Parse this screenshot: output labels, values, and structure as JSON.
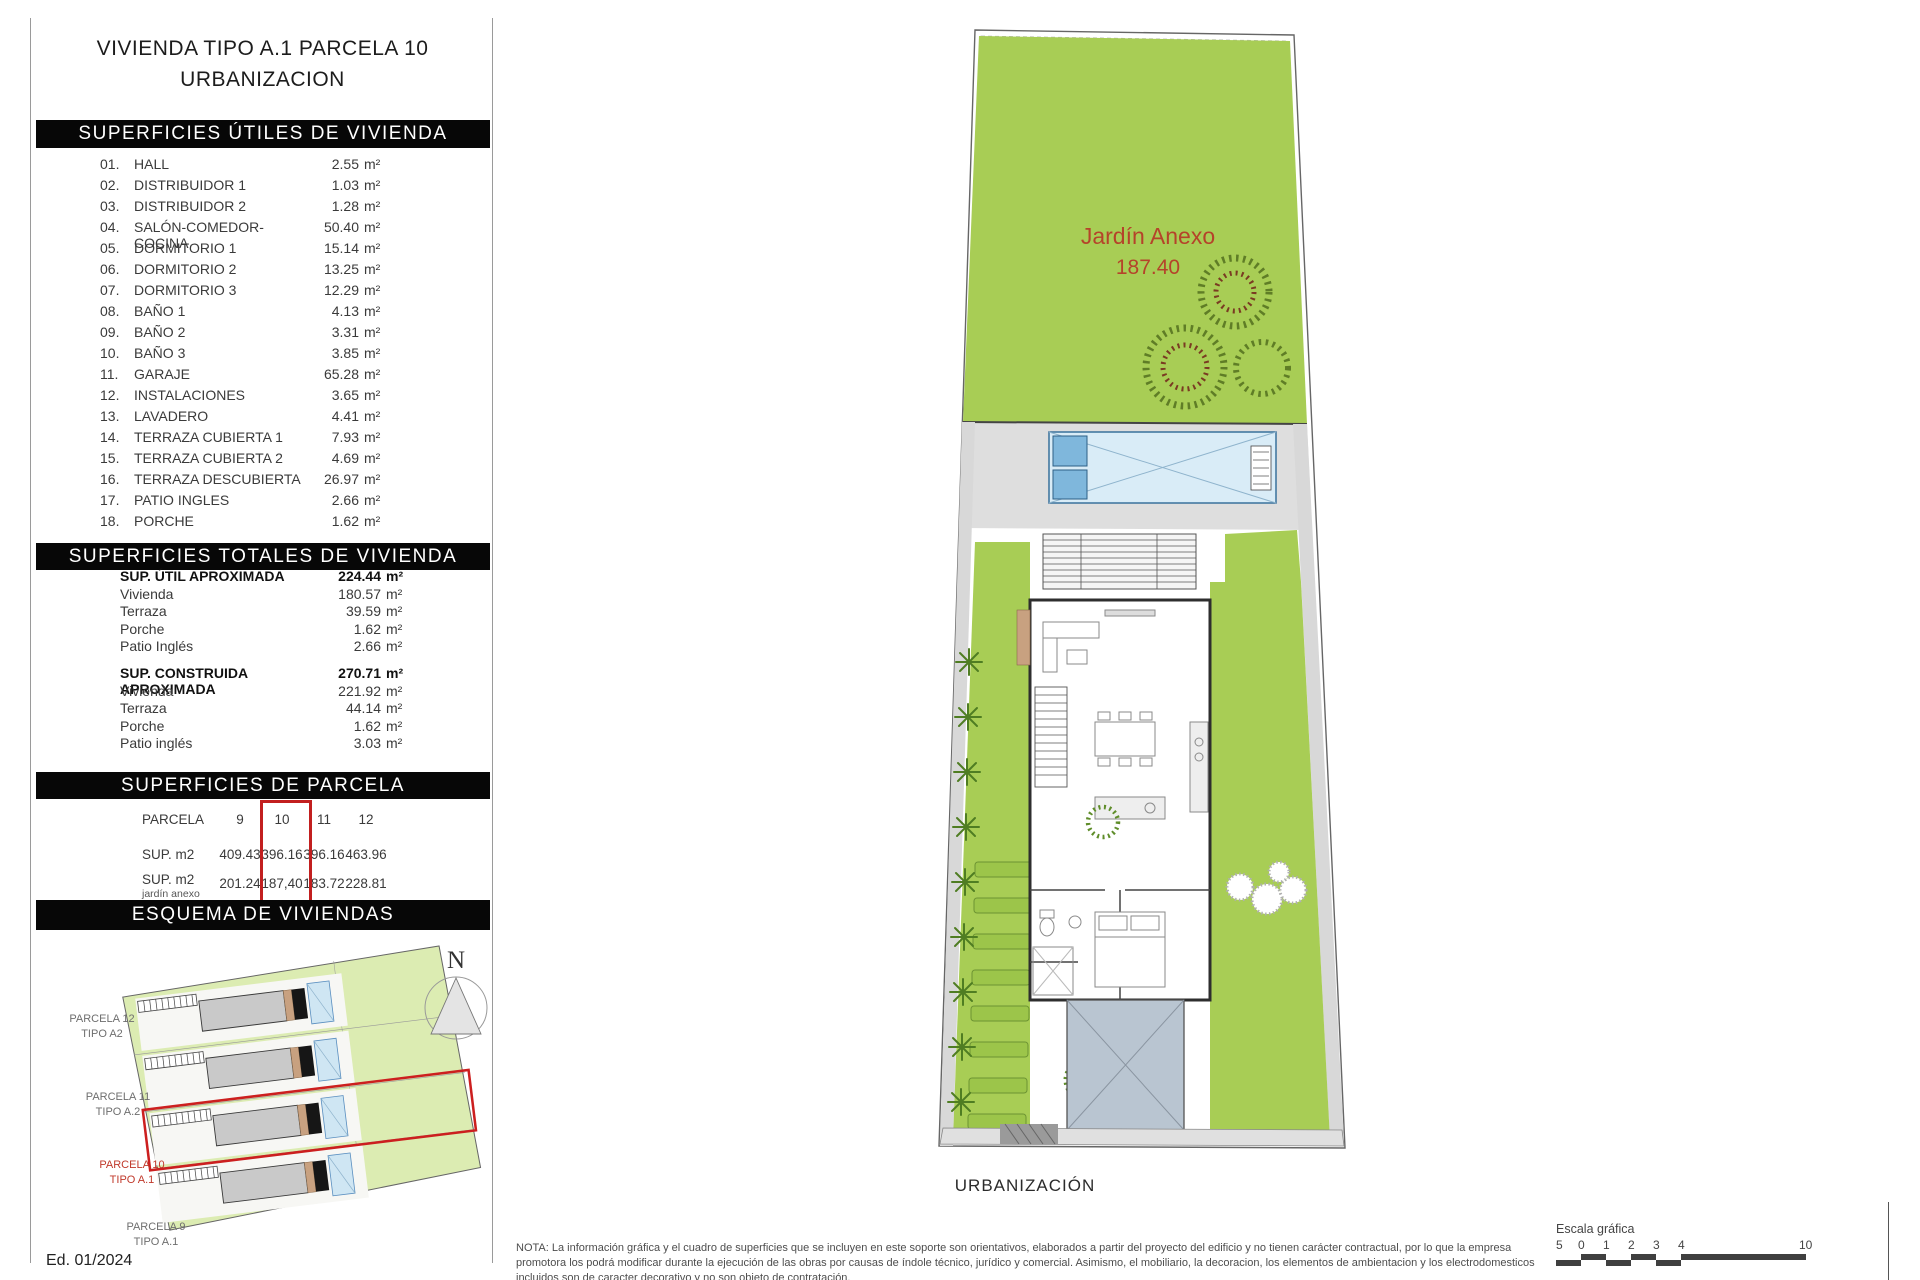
{
  "title": {
    "line1": "VIVIENDA TIPO A.1 PARCELA 10",
    "line2": "URBANIZACION"
  },
  "units": {
    "m2": "m²"
  },
  "utiles": {
    "header": "SUPERFICIES ÚTILES DE VIVIENDA",
    "rows": [
      {
        "num": "01.",
        "name": "HALL",
        "value": "2.55"
      },
      {
        "num": "02.",
        "name": "DISTRIBUIDOR 1",
        "value": "1.03"
      },
      {
        "num": "03.",
        "name": "DISTRIBUIDOR 2",
        "value": "1.28"
      },
      {
        "num": "04.",
        "name": "SALÓN-COMEDOR-COCINA",
        "value": "50.40"
      },
      {
        "num": "05.",
        "name": "DORMITORIO 1",
        "value": "15.14"
      },
      {
        "num": "06.",
        "name": "DORMITORIO 2",
        "value": "13.25"
      },
      {
        "num": "07.",
        "name": "DORMITORIO 3",
        "value": "12.29"
      },
      {
        "num": "08.",
        "name": "BAÑO 1",
        "value": "4.13"
      },
      {
        "num": "09.",
        "name": "BAÑO 2",
        "value": "3.31"
      },
      {
        "num": "10.",
        "name": "BAÑO 3",
        "value": "3.85"
      },
      {
        "num": "11.",
        "name": "GARAJE",
        "value": "65.28"
      },
      {
        "num": "12.",
        "name": "INSTALACIONES",
        "value": "3.65"
      },
      {
        "num": "13.",
        "name": "LAVADERO",
        "value": "4.41"
      },
      {
        "num": "14.",
        "name": "TERRAZA CUBIERTA 1",
        "value": "7.93"
      },
      {
        "num": "15.",
        "name": "TERRAZA CUBIERTA 2",
        "value": "4.69"
      },
      {
        "num": "16.",
        "name": "TERRAZA DESCUBIERTA",
        "value": "26.97"
      },
      {
        "num": "17.",
        "name": "PATIO INGLES",
        "value": "2.66"
      },
      {
        "num": "18.",
        "name": "PORCHE",
        "value": "1.62"
      }
    ]
  },
  "totales": {
    "header": "SUPERFICIES TOTALES DE VIVIENDA",
    "g1": {
      "label": "SUP. ÚTIL APROXIMADA",
      "value": "224.44",
      "rows": [
        {
          "name": "Vivienda",
          "value": "180.57"
        },
        {
          "name": "Terraza",
          "value": "39.59"
        },
        {
          "name": "Porche",
          "value": "1.62"
        },
        {
          "name": "Patio Inglés",
          "value": "2.66"
        }
      ]
    },
    "g2": {
      "label": "SUP. CONSTRUIDA APROXIMADA",
      "value": "270.71",
      "rows": [
        {
          "name": "Vivienda",
          "value": "221.92"
        },
        {
          "name": "Terraza",
          "value": "44.14"
        },
        {
          "name": "Porche",
          "value": "1.62"
        },
        {
          "name": "Patio inglés",
          "value": "3.03"
        }
      ]
    }
  },
  "parcela": {
    "header": "SUPERFICIES DE PARCELA",
    "col_label": "PARCELA",
    "cols": [
      "9",
      "10",
      "11",
      "12"
    ],
    "row1_label": "SUP. m2",
    "row1": [
      "409.43",
      "396.16",
      "396.16",
      "463.96"
    ],
    "row2_label": "SUP. m2",
    "row2_sublabel": "jardín anexo",
    "row2": [
      "201.24",
      "187,40",
      "183.72",
      "228.81"
    ],
    "highlight_col": "10"
  },
  "esquema": {
    "header": "ESQUEMA DE VIVIENDAS",
    "labels": {
      "p12a": "PARCELA 12",
      "p12b": "TIPO A2",
      "p11a": "PARCELA 11",
      "p11b": "TIPO A.2",
      "p10a": "PARCELA 10",
      "p10b": "TIPO A.1",
      "p9a": "PARCELA 9",
      "p9b": "TIPO A.1"
    }
  },
  "compass": {
    "n": "N"
  },
  "plan": {
    "garden_label": "Jardín Anexo",
    "garden_value": "187.40",
    "caption": "URBANIZACIÓN"
  },
  "edition": "Ed. 01/2024",
  "footer": {
    "note": "NOTA: La información gráfica y el cuadro de superficies que se incluyen en este soporte son orientativos, elaborados a partir del proyecto del edificio y no tienen carácter contractual, por lo que la empresa promotora los podrá modificar durante la ejecución de las obras por causas de índole técnico, jurídico y comercial. Asimismo, el mobiliario, la decoracion, los elementos de ambientacion y los electrodomesticos incluidos son de caracter decorativo y no son objeto de contratación.",
    "scale_label": "Escala gráfica",
    "ticks": [
      "0",
      "1",
      "2",
      "3",
      "4",
      "5"
    ],
    "tick_last": "10"
  }
}
